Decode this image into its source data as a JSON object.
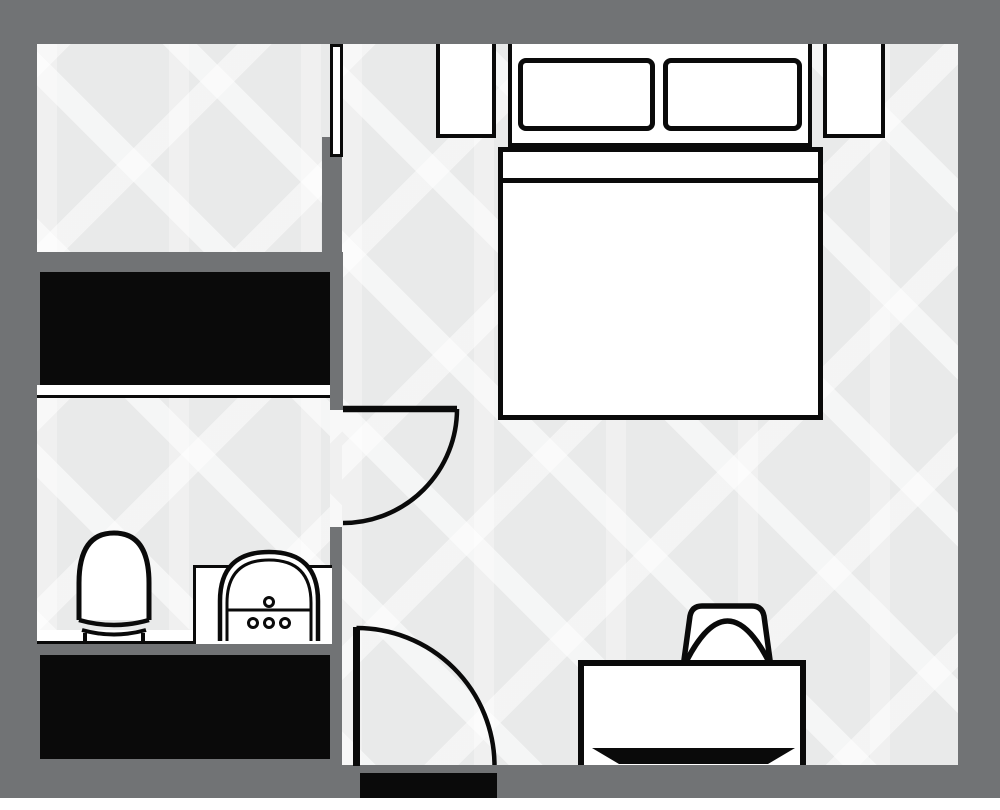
{
  "palette": {
    "wall": "#717375",
    "floor": "#e9eaea",
    "floor_motif": "#f4f5f5",
    "ink": "#0a0a0a",
    "paper": "#ffffff"
  },
  "items": {
    "plan": "studio floor plan",
    "bedroom_floor": "bedroom floor",
    "closet_floor": "closet room floor",
    "bathroom_floor": "bathroom floor",
    "window": "window",
    "wardrobe": "wardrobe unit",
    "shelf": "shelf edge",
    "toilet": "toilet",
    "sink": "sink",
    "vanity": "vanity counter",
    "counter": "bathroom counter",
    "bathroom_door": "bathroom door swing",
    "entry_door": "entry door swing",
    "entry_threshold": "entry threshold",
    "bed": "double bed",
    "pillow_left": "pillow",
    "pillow_right": "pillow",
    "nightstand_left": "nightstand",
    "nightstand_right": "nightstand",
    "desk": "desk",
    "chair": "desk chair"
  }
}
